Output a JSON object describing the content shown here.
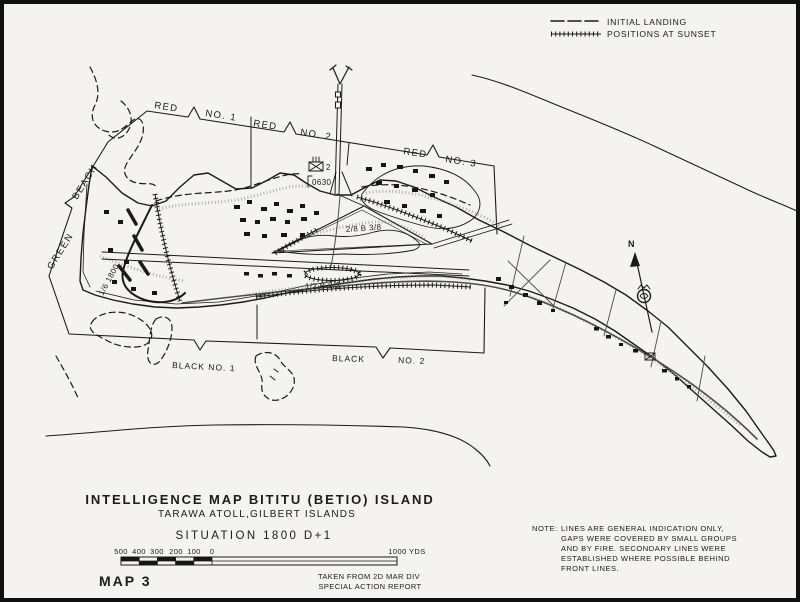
{
  "map": {
    "legend": {
      "initial_landing": "INITIAL LANDING",
      "positions_at_sunset": "POSITIONS AT SUNSET"
    },
    "beaches": {
      "red1_left": "RED",
      "red1_right": "NO. 1",
      "red2_left": "RED",
      "red2_right": "NO. 2",
      "red3_left": "RED",
      "red3_right": "NO. 3",
      "green_word1": "GREEN",
      "green_word2": "BEACH",
      "black1": "BLACK NO. 1",
      "black2_left": "BLACK",
      "black2_right": "NO. 2"
    },
    "units": {
      "pier_battalion_number": "2",
      "pier_time": "0630",
      "airfield_units": "2/8 B 3/8",
      "south_units": "1/2 B 2/2",
      "west_unit_time": "1/6 1800"
    },
    "north_label": "N",
    "title_block": {
      "title": "INTELLIGENCE MAP BITITU (BETIO) ISLAND",
      "subtitle": "TARAWA ATOLL,GILBERT ISLANDS",
      "situation": "SITUATION 1800 D+1",
      "map_number": "MAP 3",
      "credit_line1": "TAKEN FROM 2D MAR DIV",
      "credit_line2": "SPECIAL ACTION REPORT"
    },
    "scale": {
      "ticks": [
        "500",
        "400",
        "300",
        "200",
        "100",
        "0"
      ],
      "right_label": "1000 YDS"
    },
    "note": {
      "prefix": "NOTE:",
      "line1": "LINES ARE GENERAL INDICATION ONLY,",
      "line2": "GAPS WERE COVERED BY SMALL GROUPS",
      "line3": "AND BY FIRE. SECONDARY LINES WERE",
      "line4": "ESTABLISHED WHERE POSSIBLE BEHIND",
      "line5": "FRONT LINES."
    },
    "colors": {
      "paper": "#f4f3f0",
      "ink": "#1b1b1b"
    }
  }
}
